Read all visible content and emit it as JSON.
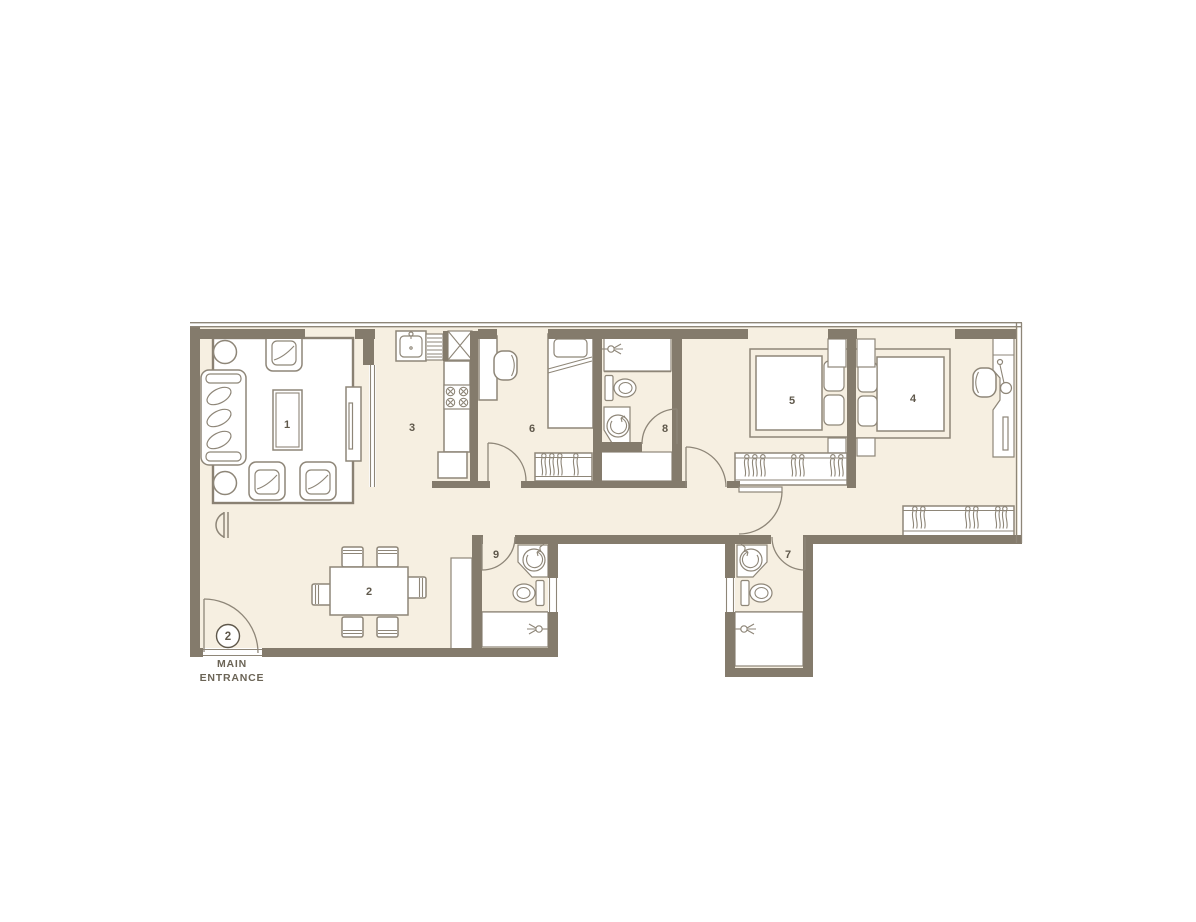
{
  "plan": {
    "entrance": {
      "badge": "2",
      "label_line1": "MAIN",
      "label_line2": "ENTRANCE"
    },
    "rooms": [
      {
        "name": "living-room",
        "label": "1"
      },
      {
        "name": "dining-area",
        "label": "2"
      },
      {
        "name": "kitchen",
        "label": "3"
      },
      {
        "name": "bedroom-right",
        "label": "4"
      },
      {
        "name": "bedroom-middle",
        "label": "5"
      },
      {
        "name": "bedroom-left",
        "label": "6"
      },
      {
        "name": "bathroom-right",
        "label": "7"
      },
      {
        "name": "bathroom-middle",
        "label": "8"
      },
      {
        "name": "bathroom-left",
        "label": "9"
      }
    ],
    "icons": [
      "sofa",
      "armchair",
      "coffee-table",
      "round-side-table",
      "tv-unit",
      "console-table",
      "dining-table",
      "dining-chair",
      "kitchen-sink",
      "faucet",
      "drainboard",
      "service-duct",
      "gas-hob",
      "refrigerator",
      "counter",
      "desk",
      "desk-chair",
      "single-bed",
      "double-bed",
      "pillow",
      "nightstand",
      "wardrobe-hangers",
      "toilet",
      "washbasin",
      "shower-head",
      "door-swing",
      "window",
      "dressing-table",
      "stool",
      "tall-cabinet"
    ]
  },
  "colors": {
    "wall": "#847b6c",
    "floor": "#f6efe1",
    "line": "#8e8678",
    "label": "#5f584b",
    "bg": "#ffffff"
  }
}
